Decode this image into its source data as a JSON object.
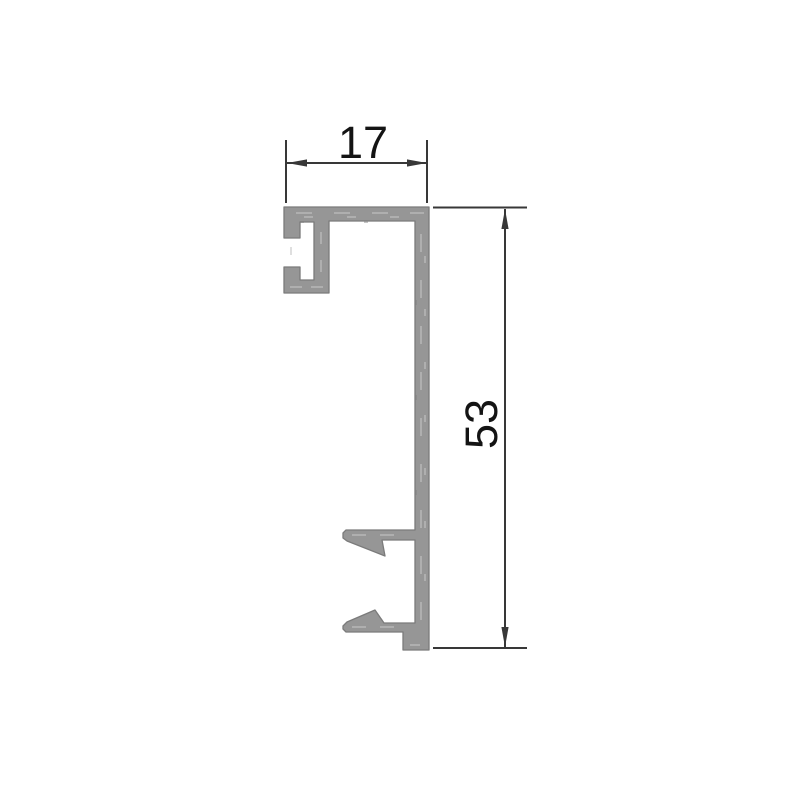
{
  "canvas": {
    "width_px": 800,
    "height_px": 800
  },
  "colors": {
    "page_background": "#ffffff",
    "profile_fill": "#969696",
    "profile_outline": "#7b7b7b",
    "profile_highlight": "#c4c4c4",
    "profile_shade": "#7f7f7f",
    "dimension_line": "#383838",
    "dimension_text": "#141414"
  },
  "drawing": {
    "kind": "aluminum-extrusion-profile-cross-section",
    "dimensions": {
      "width": {
        "value": "17"
      },
      "height": {
        "value": "53"
      }
    }
  }
}
